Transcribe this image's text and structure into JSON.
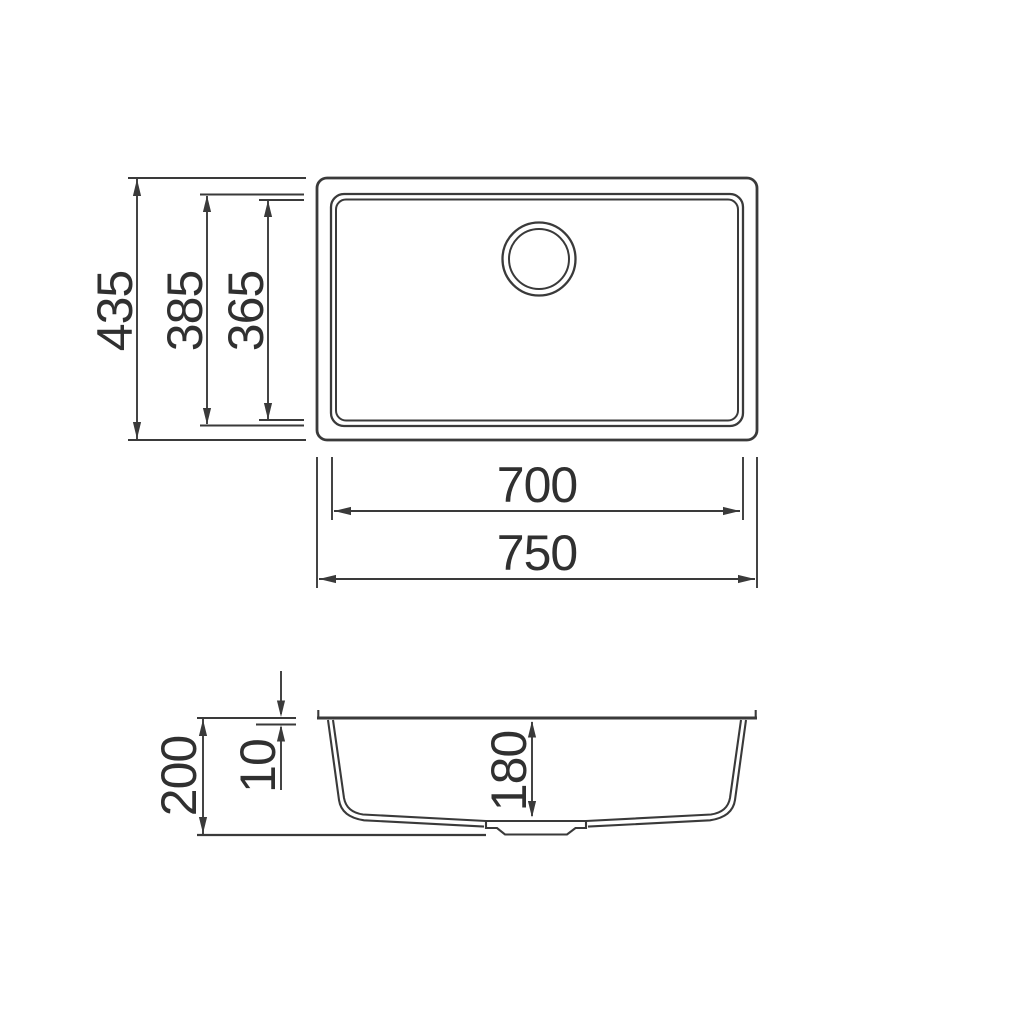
{
  "colors": {
    "background": "#ffffff",
    "line": "#3a3a3a",
    "text": "#303030"
  },
  "top_view": {
    "overall_width": "750",
    "overall_depth": "435",
    "bowl_width": "700",
    "bowl_depth": "385",
    "bowl_floor_depth": "365"
  },
  "section_view": {
    "overall_height": "200",
    "rim_thickness": "10",
    "bowl_depth": "180"
  }
}
